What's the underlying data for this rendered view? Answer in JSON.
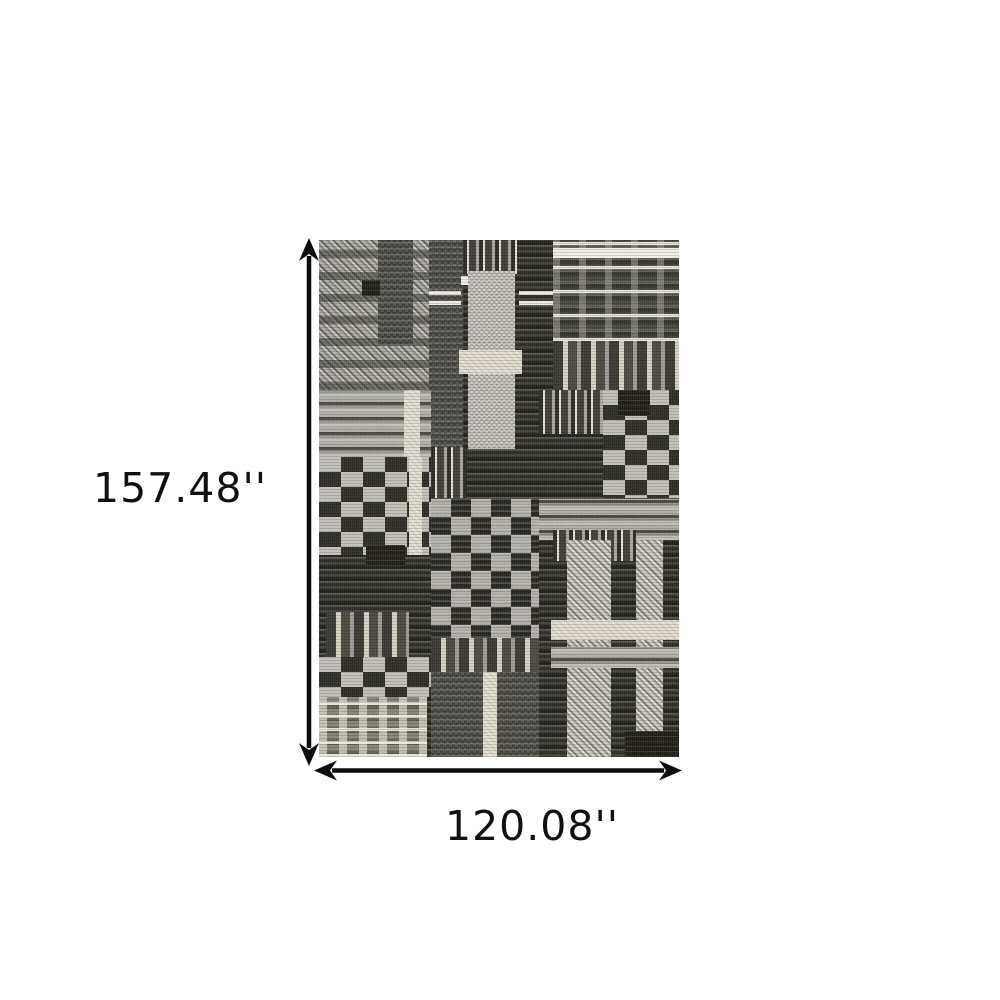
{
  "figure": {
    "title": "Rug dimensions diagram",
    "product": "Black and ivory patchwork plaid area rug"
  },
  "dimensions": {
    "height_label": "157.48''",
    "width_label": "120.08''",
    "unit": "inches"
  },
  "palette": {
    "background": "#ffffff",
    "arrow": "#0d0d0d",
    "label_text": "#101010",
    "rug_black": "#16150f",
    "rug_charcoal": "#2b2a24",
    "rug_gray": "#8e8c82",
    "rug_light": "#bcbab0",
    "rug_cream": "#d7d1c0",
    "rug_white": "#efece1"
  },
  "rug": {
    "patches": [
      {
        "x": 0,
        "y": 0,
        "w": 31,
        "h": 29,
        "c": "diag"
      },
      {
        "x": 16.5,
        "y": 0,
        "w": 9.5,
        "h": 20.5,
        "c": "darkcol"
      },
      {
        "x": 12,
        "y": 7.8,
        "w": 5,
        "h": 3,
        "c": "black"
      },
      {
        "x": 30.5,
        "y": 0,
        "w": 9.5,
        "h": 41,
        "c": "darkcol"
      },
      {
        "x": 40,
        "y": 0,
        "w": 15,
        "h": 6.5,
        "c": "vfine"
      },
      {
        "x": 65,
        "y": 0,
        "w": 35,
        "h": 19.5,
        "c": "windowpane"
      },
      {
        "x": 65,
        "y": 1.6,
        "w": 35,
        "h": 1.9,
        "c": "whiteband"
      },
      {
        "x": 39.5,
        "y": 7,
        "w": 14,
        "h": 1.8,
        "c": "whiteband"
      },
      {
        "x": 30.5,
        "y": 9.5,
        "w": 9,
        "h": 3,
        "c": "hwhite"
      },
      {
        "x": 55.5,
        "y": 9.5,
        "w": 9.5,
        "h": 3,
        "c": "hwhite"
      },
      {
        "x": 41.5,
        "y": 6,
        "w": 13,
        "h": 34.5,
        "c": "lightcol"
      },
      {
        "x": 39,
        "y": 21.3,
        "w": 17.5,
        "h": 4.6,
        "c": "cream"
      },
      {
        "x": 65,
        "y": 19.5,
        "w": 35,
        "h": 10,
        "c": "vstripes"
      },
      {
        "x": 0,
        "y": 29,
        "w": 31,
        "h": 13,
        "c": "hlight"
      },
      {
        "x": 23.5,
        "y": 29,
        "w": 4.5,
        "h": 13,
        "c": "cream"
      },
      {
        "x": 61,
        "y": 29,
        "w": 18,
        "h": 8.5,
        "c": "vfine"
      },
      {
        "x": 79,
        "y": 29,
        "w": 21,
        "h": 21,
        "c": "blocks-light"
      },
      {
        "x": 83,
        "y": 29,
        "w": 9,
        "h": 5,
        "c": "black"
      },
      {
        "x": 0,
        "y": 42,
        "w": 31,
        "h": 19,
        "c": "blocks-light"
      },
      {
        "x": 25,
        "y": 42,
        "w": 3.5,
        "h": 19,
        "c": "cream"
      },
      {
        "x": 13,
        "y": 59,
        "w": 11,
        "h": 4,
        "c": "black"
      },
      {
        "x": 31,
        "y": 40,
        "w": 10,
        "h": 10,
        "c": "vfine"
      },
      {
        "x": 31,
        "y": 50,
        "w": 30,
        "h": 27,
        "c": "blocks-grid"
      },
      {
        "x": 31,
        "y": 77,
        "w": 30,
        "h": 6.5,
        "c": "vstripes"
      },
      {
        "x": 31,
        "y": 83.5,
        "w": 30,
        "h": 16.5,
        "c": "darkcol"
      },
      {
        "x": 45.5,
        "y": 83.5,
        "w": 4,
        "h": 16.5,
        "c": "cream"
      },
      {
        "x": 61,
        "y": 50,
        "w": 39,
        "h": 8,
        "c": "hlight"
      },
      {
        "x": 65,
        "y": 56,
        "w": 23,
        "h": 6,
        "c": "vfine"
      },
      {
        "x": 69,
        "y": 58,
        "w": 12,
        "h": 42,
        "c": "diaglight"
      },
      {
        "x": 88,
        "y": 58,
        "w": 7.5,
        "h": 42,
        "c": "diaglight"
      },
      {
        "x": 64.5,
        "y": 73.5,
        "w": 35.5,
        "h": 3.8,
        "c": "cream"
      },
      {
        "x": 64.5,
        "y": 78.7,
        "w": 35.5,
        "h": 4,
        "c": "hlight"
      },
      {
        "x": 2,
        "y": 72,
        "w": 23,
        "h": 8.6,
        "c": "vstripes"
      },
      {
        "x": 0,
        "y": 80.6,
        "w": 31,
        "h": 7.8,
        "c": "blocks-light"
      },
      {
        "x": 0,
        "y": 88.4,
        "w": 30,
        "h": 11.6,
        "c": "check"
      },
      {
        "x": 85,
        "y": 95,
        "w": 15,
        "h": 5,
        "c": "black"
      }
    ]
  }
}
